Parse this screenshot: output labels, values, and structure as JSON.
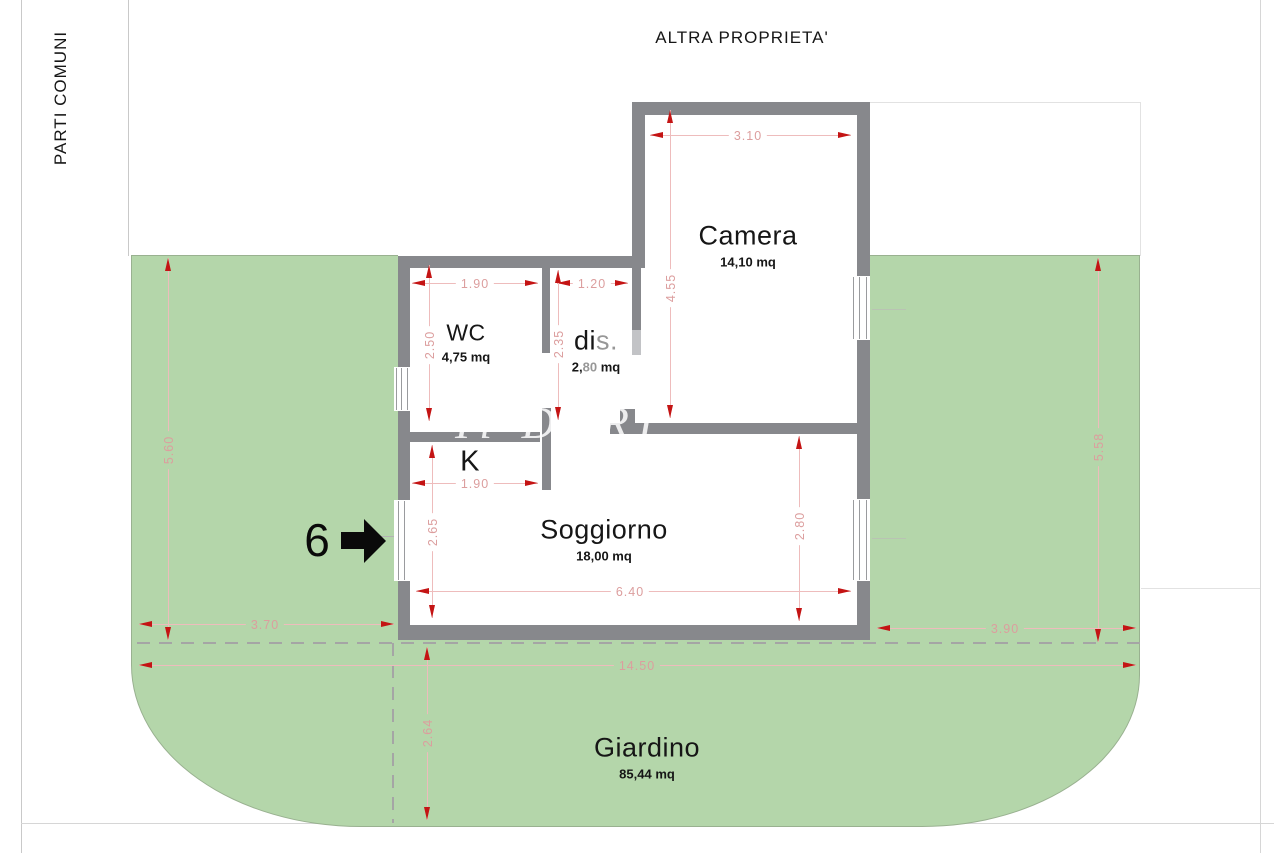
{
  "boundaries": {
    "top": "ALTRA PROPRIETA'",
    "left": "PARTI COMUNI"
  },
  "unit": {
    "number": "6"
  },
  "watermark": {
    "text": "Il DERI"
  },
  "rooms": {
    "camera": {
      "name": "Camera",
      "area": "14,10 mq"
    },
    "wc": {
      "name": "WC",
      "area": "4,75 mq"
    },
    "dis": {
      "name": "dis.",
      "name_main": "di",
      "name_faded": "s.",
      "area": "2,80 mq",
      "area_main": "2,",
      "area_faded": "80",
      "area_tail": " mq"
    },
    "kitchen": {
      "name": "K"
    },
    "soggiorno": {
      "name": "Soggiorno",
      "area": "18,00 mq"
    },
    "giardino": {
      "name": "Giardino",
      "area": "85,44 mq"
    }
  },
  "dimensions": {
    "camera_width": "3.10",
    "camera_height": "4.55",
    "wc_width": "1.90",
    "wc_height": "2.50",
    "dis_width": "1.20",
    "dis_height": "2.35",
    "kitchen_width": "1.90",
    "kitchen_height": "2.65",
    "soggiorno_width": "6.40",
    "soggiorno_height": "2.80",
    "garden_left_height": "5.60",
    "garden_left_width": "3.70",
    "garden_right_height": "5.58",
    "garden_right_width": "3.90",
    "garden_total_width": "14.50",
    "garden_bottom_height": "2.64"
  },
  "colors": {
    "garden": "#b4d6aa",
    "wall": "#87888c",
    "arrow_red": "#c41414",
    "dim_pink": "#dc9e9e"
  }
}
